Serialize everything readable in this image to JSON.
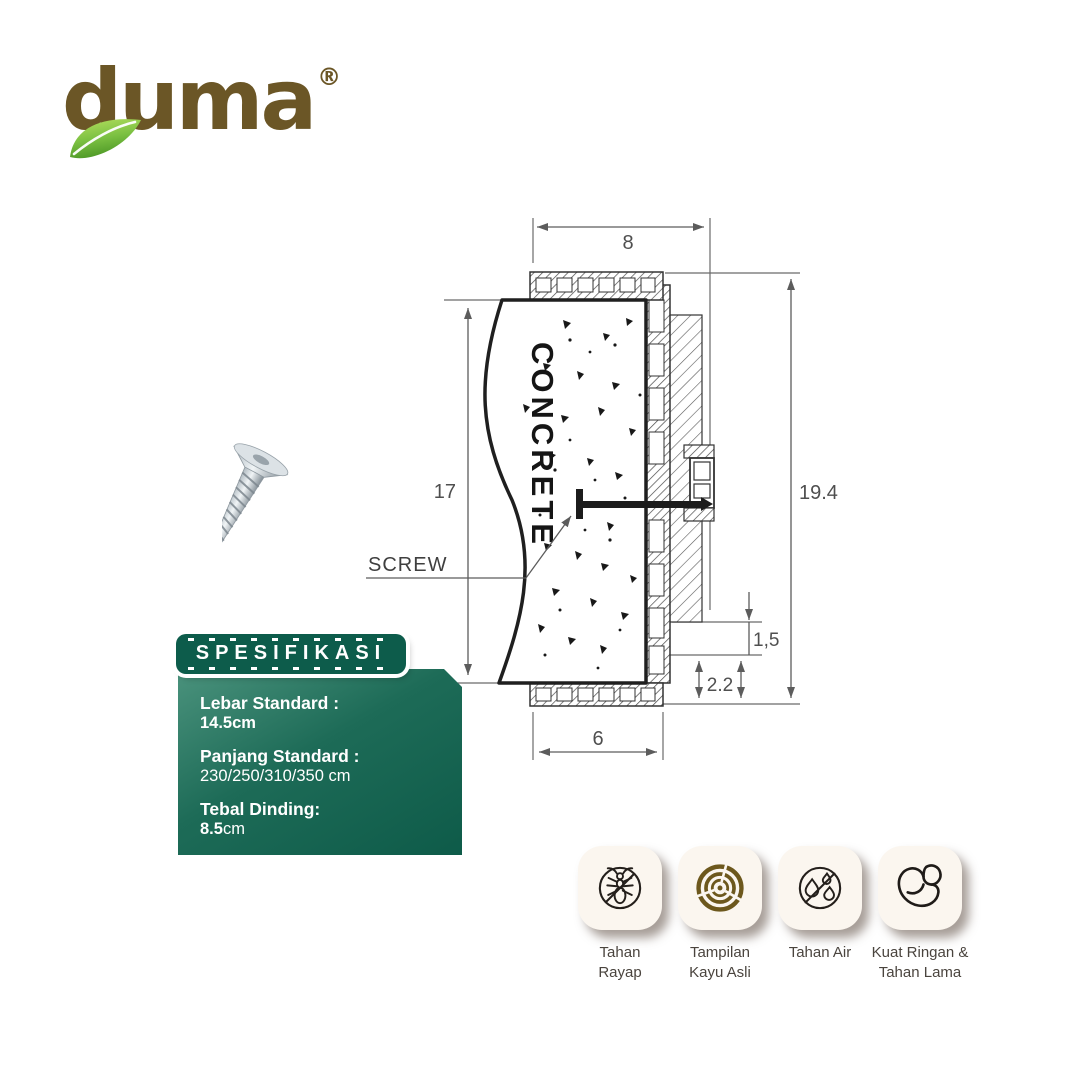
{
  "brand": {
    "name": "duma",
    "registered": "®"
  },
  "drawing": {
    "dims": {
      "top": "8",
      "left": "17",
      "right": "19.4",
      "inset_upper": "1,5",
      "inset_lower": "2.2",
      "bottom": "6"
    },
    "labels": {
      "material": "CONCRETE",
      "fastener": "SCREW"
    }
  },
  "spec": {
    "header": "SPESIFIKASI",
    "items": [
      {
        "label": "Lebar Standard :",
        "value": "14.5cm"
      },
      {
        "label": "Panjang Standard :",
        "value": "230/250/310/350 cm"
      },
      {
        "label": "Tebal Dinding:",
        "value": "8.5",
        "value_suffix": "cm"
      }
    ]
  },
  "features": [
    {
      "icon": "termite-icon",
      "l1": "Tahan",
      "l2": "Rayap"
    },
    {
      "icon": "wood-grain-icon",
      "l1": "Tampilan",
      "l2": "Kayu Asli"
    },
    {
      "icon": "water-resistant-icon",
      "l1": "Tahan Air",
      "l2": ""
    },
    {
      "icon": "muscle-icon",
      "l1": "Kuat Ringan &",
      "l2": "Tahan Lama"
    }
  ],
  "colors": {
    "logo_brown": "#6b5626",
    "leaf_green": "#7cc142",
    "spec_green_dark": "#0d5c4b",
    "spec_green_light": "#4b937d",
    "card_bg": "#fbf6ef",
    "wood_brown": "#6d581d",
    "drawing_line_gray": "#5c5c5c"
  }
}
